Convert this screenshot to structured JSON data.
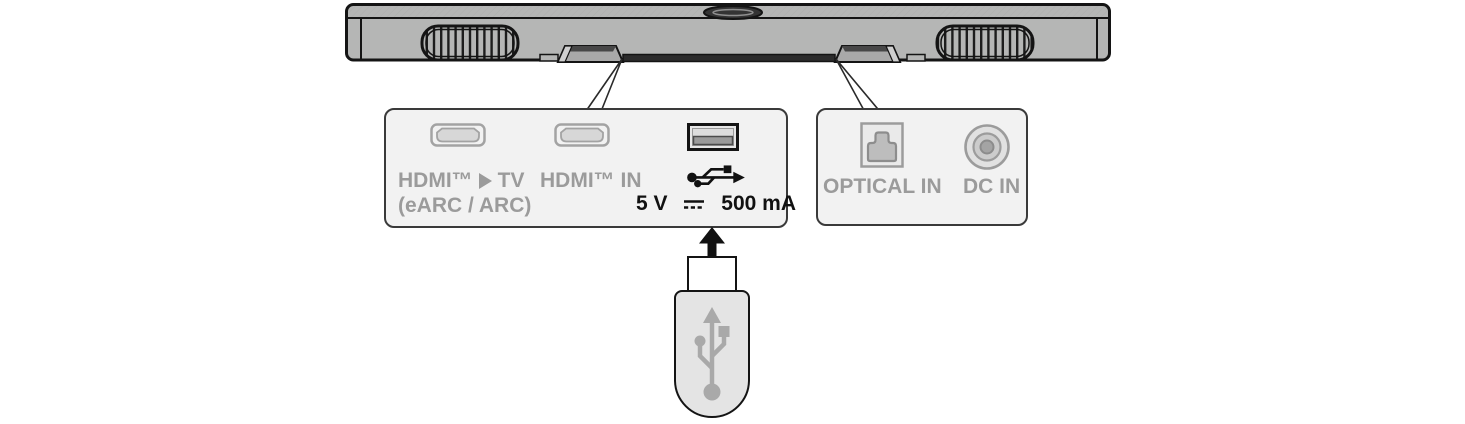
{
  "panels": {
    "left": {
      "hdmi_tv": {
        "prefix": "HDMI™",
        "suffix": "TV",
        "sub": "(eARC / ARC)"
      },
      "hdmi_in": "HDMI™ IN",
      "usb": {
        "volts": "5 V",
        "current": "500 mA"
      }
    },
    "right": {
      "optical": "OPTICAL IN",
      "dc": "DC IN"
    }
  },
  "icons": {
    "soundbar": "soundbar-rear-view",
    "callout_lines": "leader-wedges",
    "hdmi_port": "hdmi-connector",
    "usb_port": "usb-a-connector",
    "usb_symbol_black": "usb-trident-right",
    "usb_symbol_gray": "usb-trident-up",
    "optical_port": "toslink-optical-connector",
    "dc_port": "dc-power-jack",
    "dc_current_symbol": "direct-current-symbol",
    "hdmi_tv_triangle": "black-right-pointing-triangle",
    "insert_arrow": "up-arrow",
    "usb_drive": "usb-flash-drive"
  },
  "colors": {
    "outline": "#141414",
    "soundbar_body": "#b5b6b5",
    "panel_fill": "#f2f2f2",
    "panel_border": "#3a3a3a",
    "label_gray": "#9b9b9b",
    "port_outline_gray": "#a3a3a3",
    "text_black": "#111111",
    "usb_drive_fill": "#e4e4e4",
    "usb_trident_gray": "#a9a9a9"
  }
}
